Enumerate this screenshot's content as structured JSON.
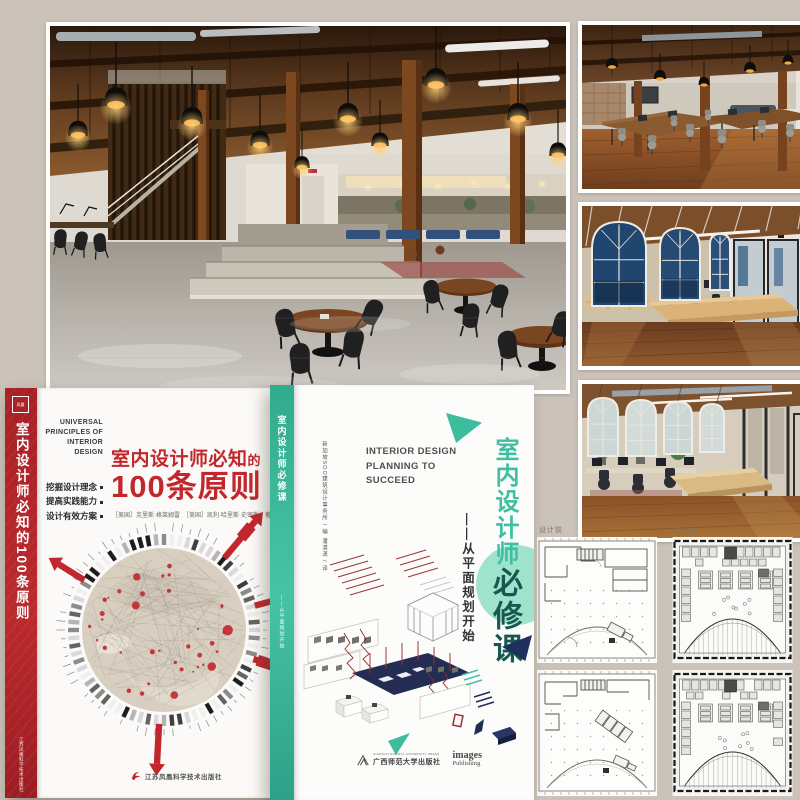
{
  "collage": {
    "background": "#cbc3b9"
  },
  "book1": {
    "accent_color": "#c1272d",
    "spine_title": "室内设计师必知的100条原则",
    "spine_publisher": "江苏凤凰科学技术出版社",
    "english_title": "UNIVERSAL\nPRINCIPLES OF\nINTERIOR\nDESIGN",
    "taglines": [
      "挖掘设计理念",
      "提高实践能力",
      "设计有效方案"
    ],
    "title_main": "室内设计师必知",
    "title_de": "的",
    "title_number": "100条原则",
    "authors": "［美国］克里斯·格莱姆雷　［美国］凯利·哈里斯·史密斯　著",
    "translator": "潘玮玲 译",
    "publisher": "江苏凤凰科学技术出版社"
  },
  "book2": {
    "accent_color": "#45c0a3",
    "emphasis_color": "#17594f",
    "spine_title": "室内设计师必修课",
    "editor_credit": "新加坡SOO建筑设计事务所 / 编",
    "translator_credit": "潘潇潇 / 译",
    "english_title": "INTERIOR DESIGN\nPLANNING TO\nSUCCEED",
    "title_vertical": "室内设计师",
    "title_emphasis": "必修课",
    "subtitle": "——从平面规划开始",
    "publisher_en_small": "GUANGXI NORMAL UNIVERSITY PRESS",
    "publisher_cn": "广西师范大学出版社",
    "imprint_line1": "images",
    "imprint_line2": "Publishing"
  },
  "floorplans": {
    "label_before": "设计前",
    "label_after": "设计后"
  }
}
